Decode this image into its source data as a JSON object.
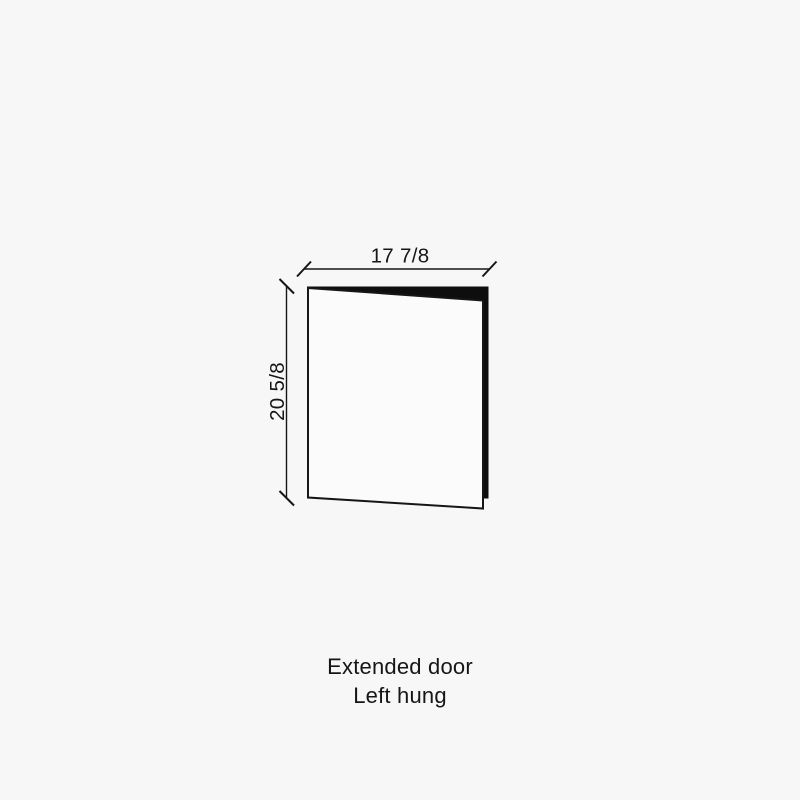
{
  "colors": {
    "background": "#f7f7f7",
    "ink": "#161616",
    "door_front_fill": "#fbfbfb",
    "door_back_fill": "#0e0e0e"
  },
  "diagram": {
    "width_dimension_label": "17 7/8",
    "height_dimension_label": "20 5/8"
  },
  "caption": {
    "line1": "Extended door",
    "line2": "Left hung"
  }
}
